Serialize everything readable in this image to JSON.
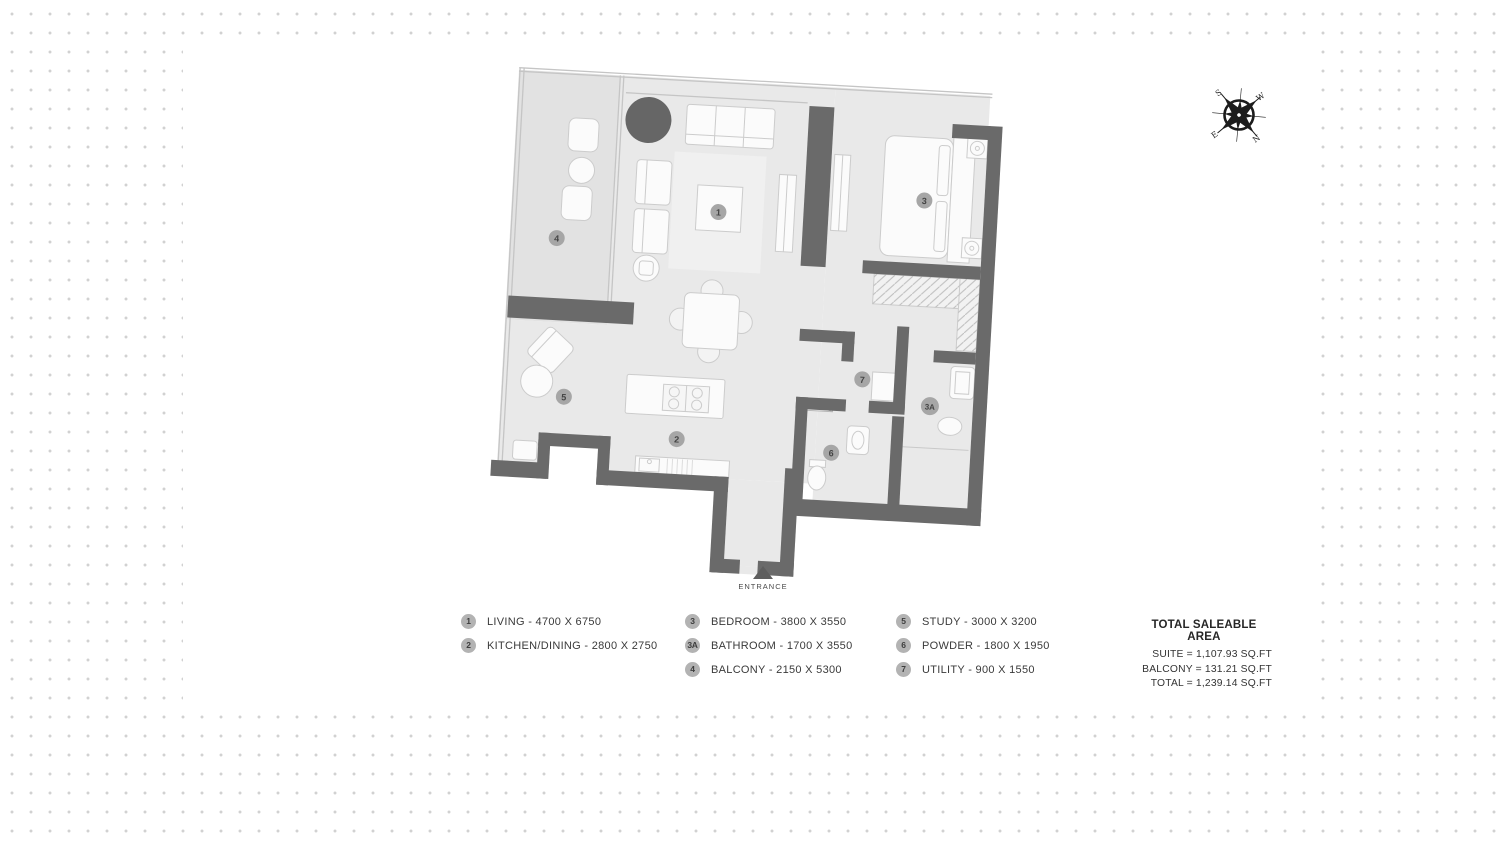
{
  "plan": {
    "entrance": {
      "label": "ENTRANCE"
    },
    "room_markers": [
      {
        "id": "1",
        "room": "living"
      },
      {
        "id": "2",
        "room": "kitchen-dining"
      },
      {
        "id": "3",
        "room": "bedroom"
      },
      {
        "id": "3A",
        "room": "bathroom"
      },
      {
        "id": "4",
        "room": "balcony"
      },
      {
        "id": "5",
        "room": "study"
      },
      {
        "id": "6",
        "room": "powder"
      },
      {
        "id": "7",
        "room": "utility"
      }
    ]
  },
  "compass": {
    "n": "N",
    "s": "S",
    "e": "E",
    "w": "W"
  },
  "legend": {
    "columns": [
      {
        "items": [
          {
            "num": "1",
            "label": "LIVING - 4700 X 6750"
          },
          {
            "num": "2",
            "label": "KITCHEN/DINING - 2800 X 2750"
          }
        ]
      },
      {
        "items": [
          {
            "num": "3",
            "label": "BEDROOM - 3800 X 3550"
          },
          {
            "num": "3A",
            "label": "BATHROOM - 1700 X 3550"
          },
          {
            "num": "4",
            "label": "BALCONY - 2150 X 5300"
          }
        ]
      },
      {
        "items": [
          {
            "num": "5",
            "label": "STUDY - 3000 X 3200"
          },
          {
            "num": "6",
            "label": "POWDER - 1800 X 1950"
          },
          {
            "num": "7",
            "label": "UTILITY - 900 X 1550"
          }
        ]
      }
    ]
  },
  "total_area": {
    "title": "TOTAL SALEABLE AREA",
    "lines": [
      {
        "text": "SUITE = 1,107.93 SQ.FT"
      },
      {
        "text": "BALCONY = 131.21 SQ.FT"
      },
      {
        "text": "TOTAL = 1,239.14 SQ.FT"
      }
    ]
  },
  "colors": {
    "background_dots": "#d1d1d1",
    "room_fill": "#e9e9e9",
    "balcony_fill": "#e2e2e2",
    "wall": "#6a6a6a",
    "furniture_fill": "#fbfbfb",
    "furniture_stroke": "#cccccc",
    "rug": "#f0f0f0",
    "accent_circle": "#666666",
    "marker_fill": "#a6a6a6",
    "legend_circle": "#b3b3b3",
    "text": "#3a3a3a",
    "compass": "#1c1c1c"
  }
}
